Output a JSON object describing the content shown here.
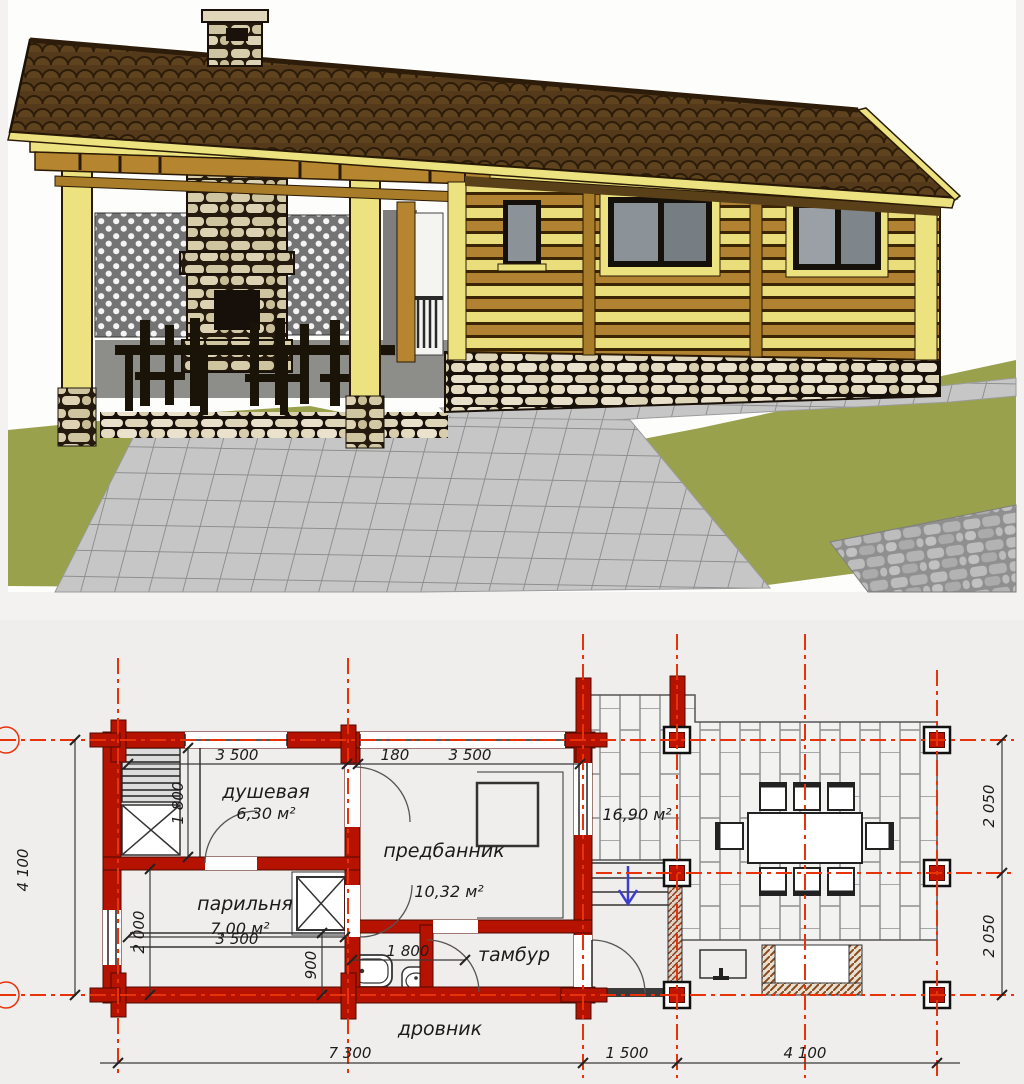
{
  "plan": {
    "labels": {
      "shower_name": "душевая",
      "shower_area": "6,30 м²",
      "steam_name": "парильня",
      "steam_area": "7,00 м²",
      "anteroom_name": "предбанник",
      "anteroom_area": "10,32 м²",
      "vestibule_name": "тамбур",
      "woodshed_name": "дровник",
      "terrace_area": "16,90 м²"
    },
    "dims": {
      "top_left": "3 500",
      "top_wall": "180",
      "top_right": "3 500",
      "steam_width": "3 500",
      "shower_height": "1 800",
      "steam_height": "2 000",
      "corridor": "900",
      "bath_width": "1 800",
      "bottom_main": "7 300",
      "bottom_porch": "1 500",
      "bottom_terrace": "4 100",
      "left_total": "4 100",
      "right_upper": "2 050",
      "right_lower": "2 050"
    },
    "colors": {
      "wall_red": "#b51300",
      "axis_red": "#e8330a",
      "line_dark": "#3a3a3a",
      "arrow_blue": "#3c3cd0"
    }
  },
  "render": {
    "colors": {
      "roof_brown": "#54391b",
      "trim_yellow": "#ece27f",
      "wood_brown": "#b5862f",
      "lawn_olive": "#9aa14c",
      "stone_beige": "#ddd3b4",
      "paving_gray": "#c6c6c6"
    }
  }
}
